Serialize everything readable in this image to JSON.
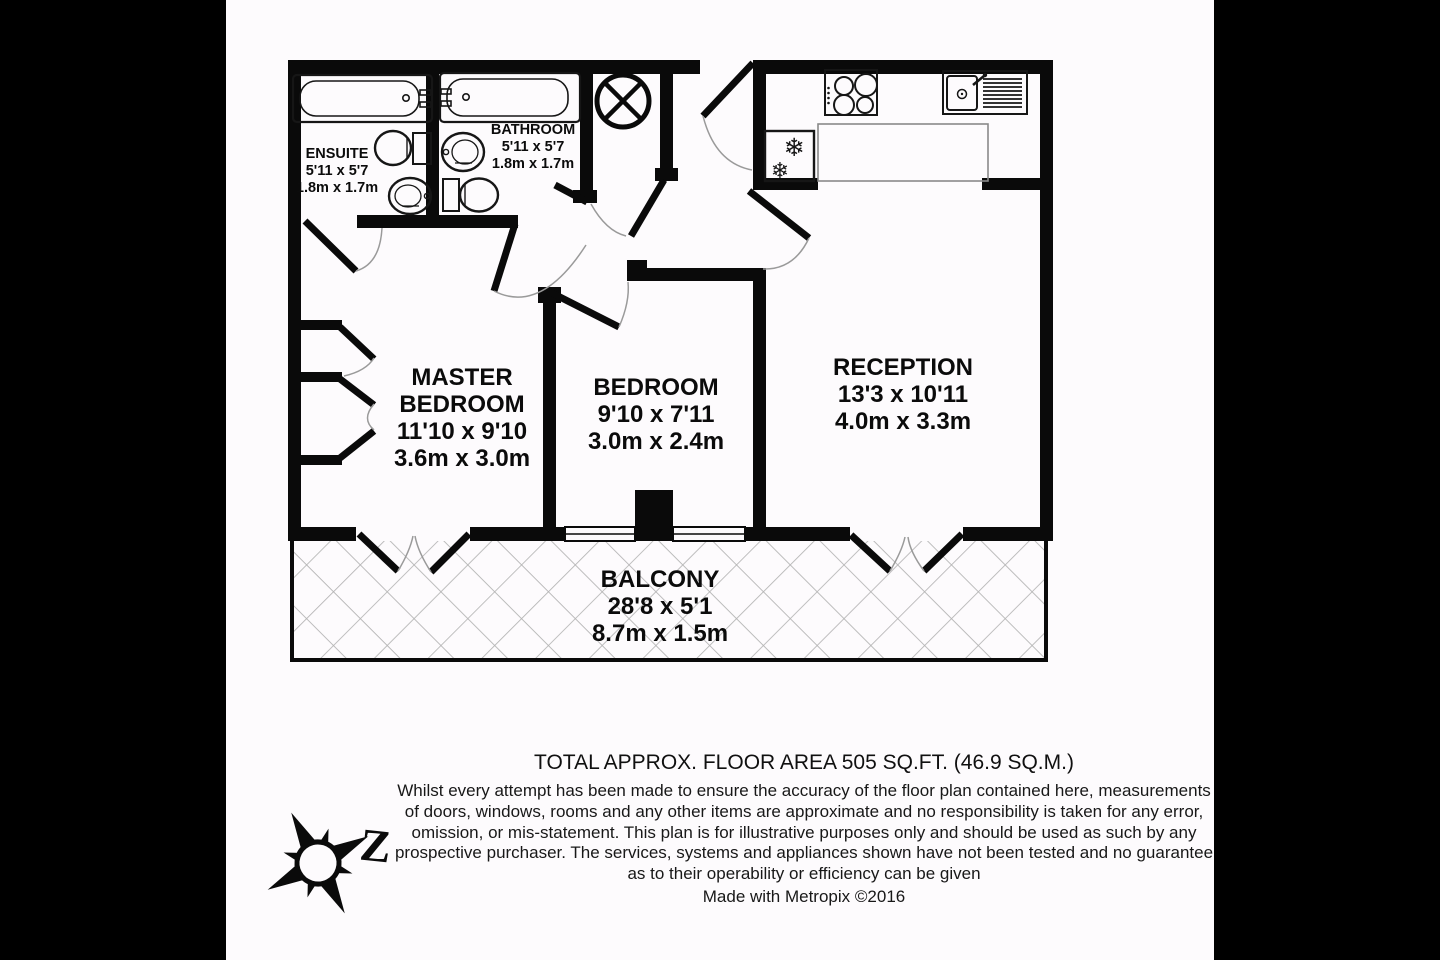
{
  "colors": {
    "letterbox": "#000000",
    "paper": "#fdfbfd",
    "wall": "#0a0a0a",
    "hatch": "#b4b4b4",
    "swing_arc": "#9a9a9a"
  },
  "rooms": {
    "ensuite": {
      "lines": [
        "ENSUITE",
        "5'11 x 5'7",
        "1.8m x 1.7m"
      ]
    },
    "bathroom": {
      "lines": [
        "BATHROOM",
        "5'11 x 5'7",
        "1.8m x 1.7m"
      ]
    },
    "master_bedroom": {
      "lines": [
        "MASTER",
        "BEDROOM",
        "11'10 x 9'10",
        "3.6m x 3.0m"
      ]
    },
    "bedroom": {
      "lines": [
        "BEDROOM",
        "9'10 x 7'11",
        "3.0m x 2.4m"
      ]
    },
    "reception": {
      "lines": [
        "RECEPTION",
        "13'3 x 10'11",
        "4.0m x 3.3m"
      ]
    },
    "balcony": {
      "lines": [
        "BALCONY",
        "28'8 x 5'1",
        "8.7m x 1.5m"
      ]
    }
  },
  "footer": {
    "area_title": "TOTAL APPROX. FLOOR AREA 505 SQ.FT. (46.9 SQ.M.)",
    "disclaimer_lines": [
      "Whilst every attempt has been made to ensure the accuracy of the floor plan contained here, measurements",
      "of doors, windows, rooms and any other items are approximate and no responsibility is taken for any error,",
      "omission, or mis-statement. This plan is for illustrative purposes only and should be used as such by any",
      "prospective purchaser. The services, systems and appliances shown have not been tested and no guarantee",
      "as to their operability or efficiency can be given"
    ],
    "credit": "Made with Metropix ©2016"
  },
  "compass": {
    "label": "Z"
  },
  "icons": {
    "snowflake": "❄"
  }
}
